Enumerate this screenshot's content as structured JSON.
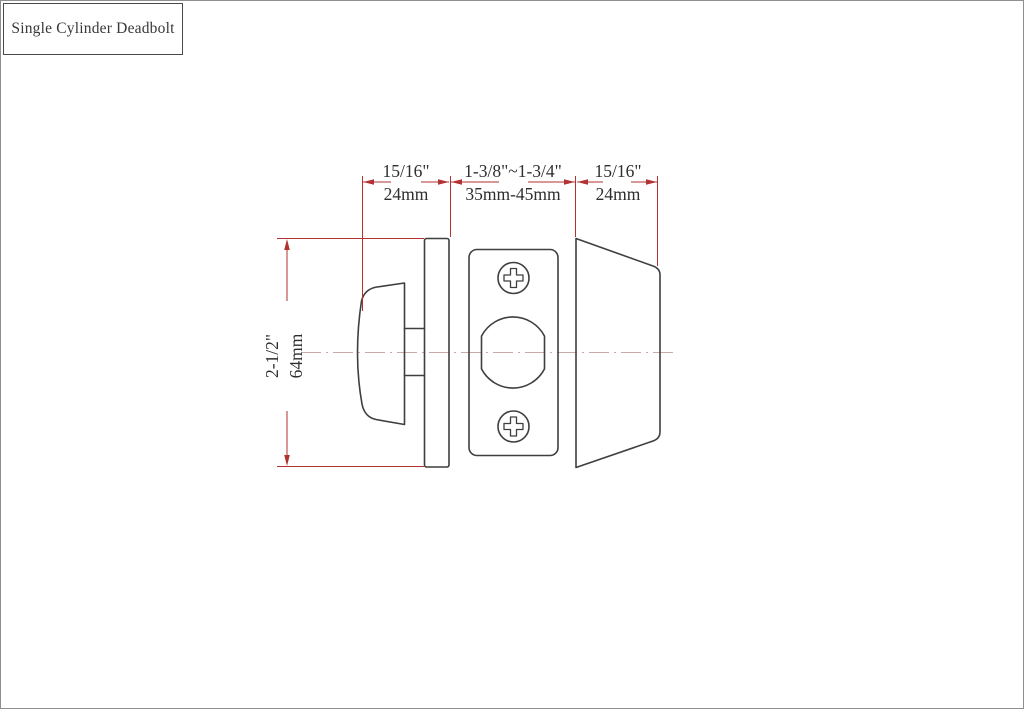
{
  "title": {
    "label": "Single Cylinder Deadbolt"
  },
  "drawing": {
    "type": "technical-dimension-diagram",
    "parts": [
      "thumbturn",
      "interior-rose-plate",
      "latch-faceplate-with-screws",
      "exterior-cylinder-housing"
    ],
    "dimensions": {
      "left": {
        "inch": "15/16\"",
        "mm": "24mm"
      },
      "middle": {
        "inch": "1-3/8\"~1-3/4\"",
        "mm": "35mm-45mm"
      },
      "right": {
        "inch": "15/16\"",
        "mm": "24mm"
      },
      "height": {
        "inch": "2-1/2\"",
        "mm": "64mm"
      }
    },
    "colors": {
      "outline": "#3f3f3f",
      "dimension_lines": "#b23232",
      "centerline": "#c9aaaa",
      "text": "#2e2e2e",
      "background": "#ffffff",
      "page_border": "#8f8f8f"
    }
  }
}
